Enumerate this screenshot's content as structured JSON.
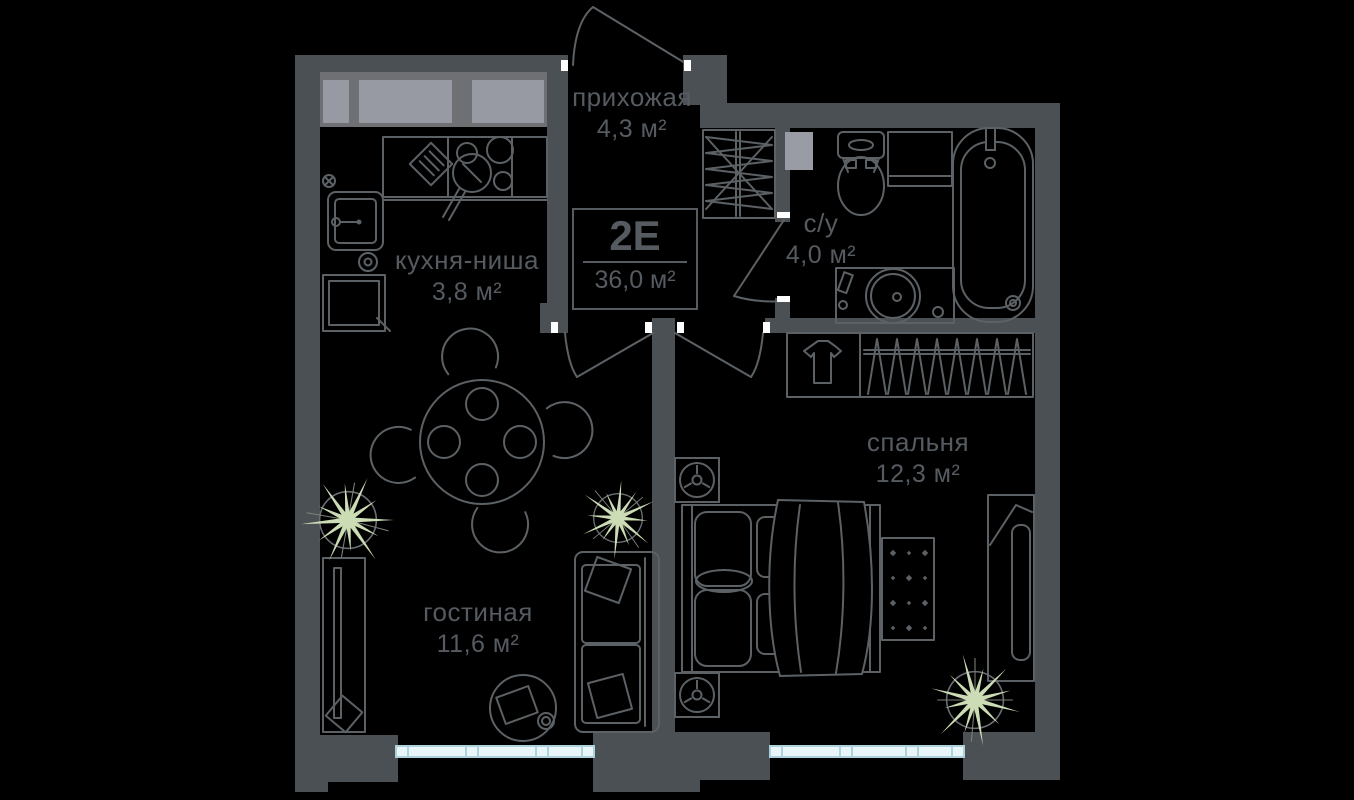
{
  "unit": {
    "type_label": "2Е",
    "area": "36,0 м²"
  },
  "rooms": [
    {
      "name": "прихожая",
      "area": "4,3 м²"
    },
    {
      "name": "кухня-ниша",
      "area": "3,8 м²"
    },
    {
      "name": "с/у",
      "area": "4,0 м²"
    },
    {
      "name": "спальня",
      "area": "12,3 м²"
    },
    {
      "name": "гостиная",
      "area": "11,6 м²"
    }
  ],
  "colors": {
    "background": "#000000",
    "wall": "#4b5055",
    "furniture_line": "#5c6165",
    "text": "#565b61",
    "window_frame_band": "#6e7073",
    "window_glass": "#989aa3",
    "bottom_window_fill": "#eaf5f9",
    "bottom_window_border": "#aed2dc",
    "plant_leaf": "#ccdcb4",
    "door_tick": "#ffffff"
  }
}
